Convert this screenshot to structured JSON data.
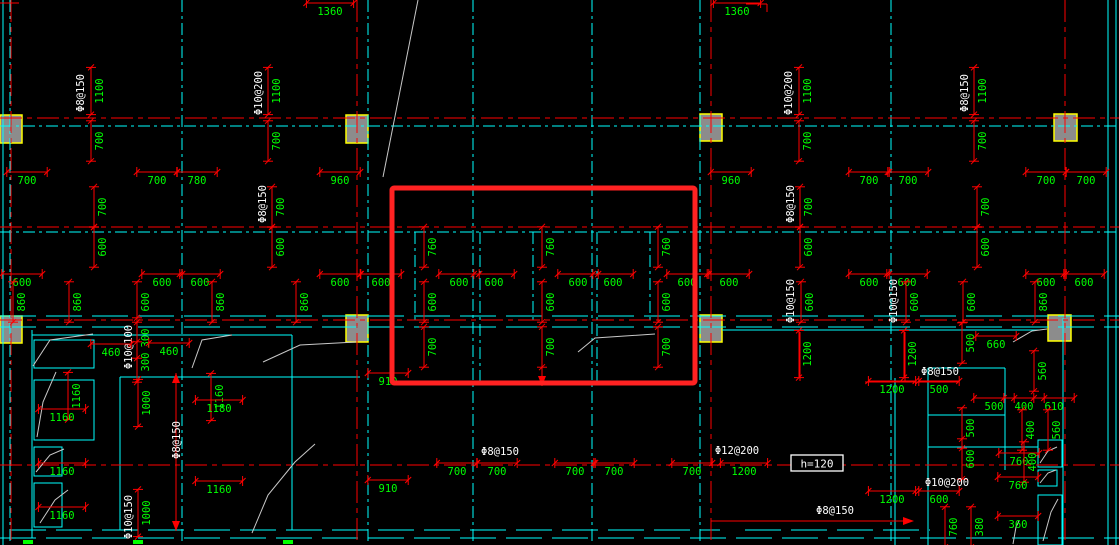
{
  "scene": {
    "w": 1119,
    "h": 545,
    "bg": "#000000"
  },
  "colors": {
    "grid_cyan": "#00ffff",
    "axis_red": "#ff0000",
    "dim_red": "#ff0000",
    "dim_text_green": "#00ff00",
    "rebar_text_white": "#ffffff",
    "column_fill": "#8c8c8c",
    "column_border": "#ffff00",
    "break_line_gray": "#c8c8c8",
    "highlight_red": "#ff2222"
  },
  "highlight_rect": {
    "x": 392,
    "y": 188,
    "w": 303,
    "h": 195,
    "stroke_width": 5
  },
  "note_box": {
    "text": "h=120",
    "x": 791,
    "y": 455,
    "w": 52,
    "h": 16
  },
  "columns": [
    [
      0,
      115,
      22,
      28
    ],
    [
      346,
      115,
      22,
      28
    ],
    [
      700,
      114,
      22,
      27
    ],
    [
      1054,
      114,
      23,
      27
    ],
    [
      0,
      316,
      22,
      27
    ],
    [
      346,
      315,
      22,
      27
    ],
    [
      700,
      315,
      22,
      27
    ],
    [
      1048,
      315,
      23,
      26
    ]
  ],
  "axes": {
    "horizontal": [
      118,
      227,
      320,
      465
    ],
    "vertical": [
      11,
      357,
      711,
      1065
    ]
  },
  "cyan_lines": [
    [
      3,
      0,
      3,
      545,
      "solid"
    ],
    [
      10,
      0,
      10,
      545,
      "grid"
    ],
    [
      182,
      0,
      182,
      545,
      "grid"
    ],
    [
      368,
      0,
      368,
      545,
      "grid"
    ],
    [
      473,
      0,
      473,
      545,
      "grid"
    ],
    [
      592,
      0,
      592,
      545,
      "grid"
    ],
    [
      700,
      0,
      700,
      545,
      "grid"
    ],
    [
      891,
      0,
      891,
      545,
      "grid"
    ],
    [
      1108,
      0,
      1108,
      545,
      "solid"
    ],
    [
      1116,
      0,
      1116,
      545,
      "solid"
    ],
    [
      415,
      232,
      415,
      322,
      "grid"
    ],
    [
      480,
      232,
      480,
      385,
      "grid"
    ],
    [
      533,
      232,
      533,
      322,
      "grid"
    ],
    [
      597,
      232,
      597,
      385,
      "grid"
    ],
    [
      650,
      232,
      650,
      322,
      "grid"
    ],
    [
      0,
      126,
      1119,
      126,
      "grid"
    ],
    [
      0,
      232,
      1119,
      232,
      "grid"
    ],
    [
      0,
      316,
      1119,
      316,
      "long"
    ],
    [
      0,
      327,
      1119,
      327,
      "long"
    ],
    [
      32,
      330,
      32,
      538,
      "solid"
    ],
    [
      32,
      335,
      292,
      335,
      "solid"
    ],
    [
      292,
      335,
      292,
      530,
      "solid"
    ],
    [
      120,
      377,
      120,
      530,
      "solid"
    ],
    [
      120,
      377,
      360,
      377,
      "solid"
    ],
    [
      10,
      530,
      720,
      530,
      "long"
    ],
    [
      0,
      538,
      1119,
      538,
      "long"
    ],
    [
      722,
      330,
      1040,
      330,
      "solid"
    ],
    [
      895,
      378,
      895,
      545,
      "solid"
    ],
    [
      928,
      368,
      928,
      545,
      "solid"
    ],
    [
      928,
      368,
      1005,
      368,
      "solid"
    ],
    [
      928,
      415,
      1005,
      415,
      "solid"
    ],
    [
      928,
      447,
      1038,
      447,
      "solid"
    ],
    [
      1005,
      368,
      1005,
      470,
      "solid"
    ],
    [
      1063,
      318,
      1063,
      545,
      "solid"
    ],
    [
      745,
      530,
      930,
      530,
      "long"
    ]
  ],
  "cyan_rects": [
    [
      34,
      340,
      60,
      28
    ],
    [
      34,
      380,
      60,
      60
    ],
    [
      34,
      447,
      28,
      29
    ],
    [
      34,
      483,
      28,
      44
    ],
    [
      1038,
      440,
      24,
      27
    ],
    [
      1038,
      470,
      19,
      16
    ],
    [
      1038,
      495,
      24,
      50
    ]
  ],
  "red_segments": [
    [
      0,
      3,
      19,
      3
    ],
    [
      746,
      4,
      767,
      4
    ],
    [
      767,
      4,
      767,
      12
    ],
    [
      800,
      332,
      800,
      381
    ],
    [
      905,
      332,
      905,
      381
    ],
    [
      865,
      382,
      958,
      382
    ],
    [
      542,
      367,
      542,
      386
    ],
    [
      711,
      521,
      905,
      521
    ],
    [
      176,
      373,
      176,
      531
    ]
  ],
  "red_arrows": [
    {
      "x": 905,
      "y": 521,
      "d": "r"
    },
    {
      "x": 176,
      "y": 373,
      "d": "u"
    },
    {
      "x": 176,
      "y": 531,
      "d": "d"
    },
    {
      "x": 542,
      "y": 386,
      "d": "d"
    }
  ],
  "bottom_ticks": [
    [
      23,
      540
    ],
    [
      133,
      540
    ],
    [
      283,
      540
    ]
  ],
  "break_lines": [
    [
      [
        418,
        0
      ],
      [
        383,
        177
      ]
    ],
    [
      [
        33,
        366
      ],
      [
        50,
        340
      ],
      [
        93,
        334
      ]
    ],
    [
      [
        37,
        437
      ],
      [
        43,
        402
      ],
      [
        56,
        372
      ]
    ],
    [
      [
        192,
        368
      ],
      [
        202,
        340
      ],
      [
        232,
        335
      ]
    ],
    [
      [
        263,
        362
      ],
      [
        300,
        345
      ],
      [
        356,
        342
      ]
    ],
    [
      [
        252,
        533
      ],
      [
        268,
        495
      ],
      [
        295,
        462
      ],
      [
        315,
        444
      ]
    ],
    [
      [
        36,
        472
      ],
      [
        50,
        455
      ],
      [
        64,
        449
      ]
    ],
    [
      [
        40,
        523
      ],
      [
        55,
        500
      ],
      [
        68,
        490
      ]
    ],
    [
      [
        578,
        352
      ],
      [
        595,
        338
      ],
      [
        655,
        334
      ]
    ],
    [
      [
        1013,
        342
      ],
      [
        1032,
        331
      ],
      [
        1047,
        329
      ]
    ],
    [
      [
        1040,
        463
      ],
      [
        1048,
        451
      ],
      [
        1057,
        447
      ]
    ],
    [
      [
        1040,
        483
      ],
      [
        1048,
        473
      ],
      [
        1056,
        470
      ]
    ],
    [
      [
        1043,
        541
      ],
      [
        1051,
        512
      ],
      [
        1058,
        499
      ]
    ],
    [
      [
        1013,
        544
      ],
      [
        1016,
        527
      ],
      [
        1019,
        521
      ]
    ]
  ],
  "labels": [
    {
      "t": "1360",
      "x": 330,
      "y": 12
    },
    {
      "t": "1360",
      "x": 737,
      "y": 12
    },
    {
      "t": "Φ8@150",
      "x": 81,
      "y": 93,
      "r": 1,
      "c": "w"
    },
    {
      "t": "1100",
      "x": 100,
      "y": 91,
      "r": 1
    },
    {
      "t": "700",
      "x": 100,
      "y": 141,
      "r": 1
    },
    {
      "t": "Φ10@200",
      "x": 259,
      "y": 93,
      "r": 1,
      "c": "w"
    },
    {
      "t": "1100",
      "x": 277,
      "y": 91,
      "r": 1
    },
    {
      "t": "700",
      "x": 277,
      "y": 141,
      "r": 1
    },
    {
      "t": "Φ10@200",
      "x": 789,
      "y": 93,
      "r": 1,
      "c": "w"
    },
    {
      "t": "1100",
      "x": 808,
      "y": 91,
      "r": 1
    },
    {
      "t": "700",
      "x": 808,
      "y": 141,
      "r": 1
    },
    {
      "t": "Φ8@150",
      "x": 965,
      "y": 93,
      "r": 1,
      "c": "w"
    },
    {
      "t": "1100",
      "x": 983,
      "y": 91,
      "r": 1
    },
    {
      "t": "700",
      "x": 983,
      "y": 141,
      "r": 1
    },
    {
      "t": "700",
      "x": 27,
      "y": 181
    },
    {
      "t": "700",
      "x": 157,
      "y": 181
    },
    {
      "t": "780",
      "x": 197,
      "y": 181
    },
    {
      "t": "960",
      "x": 340,
      "y": 181
    },
    {
      "t": "960",
      "x": 731,
      "y": 181
    },
    {
      "t": "700",
      "x": 869,
      "y": 181
    },
    {
      "t": "700",
      "x": 908,
      "y": 181
    },
    {
      "t": "700",
      "x": 1046,
      "y": 181
    },
    {
      "t": "700",
      "x": 1086,
      "y": 181
    },
    {
      "t": "700",
      "x": 103,
      "y": 207,
      "r": 1
    },
    {
      "t": "600",
      "x": 103,
      "y": 247,
      "r": 1
    },
    {
      "t": "Φ8@150",
      "x": 263,
      "y": 204,
      "r": 1,
      "c": "w"
    },
    {
      "t": "700",
      "x": 281,
      "y": 207,
      "r": 1
    },
    {
      "t": "600",
      "x": 281,
      "y": 247,
      "r": 1
    },
    {
      "t": "Φ8@150",
      "x": 791,
      "y": 204,
      "r": 1,
      "c": "w"
    },
    {
      "t": "700",
      "x": 809,
      "y": 207,
      "r": 1
    },
    {
      "t": "600",
      "x": 809,
      "y": 247,
      "r": 1
    },
    {
      "t": "700",
      "x": 986,
      "y": 207,
      "r": 1
    },
    {
      "t": "600",
      "x": 986,
      "y": 247,
      "r": 1
    },
    {
      "t": "760",
      "x": 433,
      "y": 247,
      "r": 1
    },
    {
      "t": "760",
      "x": 551,
      "y": 247,
      "r": 1
    },
    {
      "t": "760",
      "x": 667,
      "y": 247,
      "r": 1
    },
    {
      "t": "600",
      "x": 433,
      "y": 302,
      "r": 1
    },
    {
      "t": "600",
      "x": 551,
      "y": 302,
      "r": 1
    },
    {
      "t": "600",
      "x": 667,
      "y": 302,
      "r": 1
    },
    {
      "t": "700",
      "x": 433,
      "y": 347,
      "r": 1
    },
    {
      "t": "700",
      "x": 551,
      "y": 347,
      "r": 1
    },
    {
      "t": "700",
      "x": 667,
      "y": 347,
      "r": 1
    },
    {
      "t": "600",
      "x": 22,
      "y": 283
    },
    {
      "t": "600",
      "x": 162,
      "y": 283
    },
    {
      "t": "600",
      "x": 200,
      "y": 283
    },
    {
      "t": "600",
      "x": 340,
      "y": 283
    },
    {
      "t": "600",
      "x": 381,
      "y": 283
    },
    {
      "t": "600",
      "x": 459,
      "y": 283
    },
    {
      "t": "600",
      "x": 494,
      "y": 283
    },
    {
      "t": "600",
      "x": 578,
      "y": 283
    },
    {
      "t": "600",
      "x": 613,
      "y": 283
    },
    {
      "t": "600",
      "x": 687,
      "y": 283
    },
    {
      "t": "600",
      "x": 729,
      "y": 283
    },
    {
      "t": "600",
      "x": 869,
      "y": 283
    },
    {
      "t": "600",
      "x": 907,
      "y": 283
    },
    {
      "t": "600",
      "x": 1046,
      "y": 283
    },
    {
      "t": "600",
      "x": 1084,
      "y": 283
    },
    {
      "t": "860",
      "x": 22,
      "y": 302,
      "r": 1
    },
    {
      "t": "860",
      "x": 78,
      "y": 302,
      "r": 1
    },
    {
      "t": "600",
      "x": 146,
      "y": 302,
      "r": 1
    },
    {
      "t": "860",
      "x": 221,
      "y": 302,
      "r": 1
    },
    {
      "t": "860",
      "x": 305,
      "y": 302,
      "r": 1
    },
    {
      "t": "Φ10@150",
      "x": 791,
      "y": 301,
      "r": 1,
      "c": "w"
    },
    {
      "t": "600",
      "x": 810,
      "y": 302,
      "r": 1
    },
    {
      "t": "Φ10@150",
      "x": 894,
      "y": 301,
      "r": 1,
      "c": "w"
    },
    {
      "t": "600",
      "x": 915,
      "y": 302,
      "r": 1
    },
    {
      "t": "600",
      "x": 972,
      "y": 302,
      "r": 1
    },
    {
      "t": "860",
      "x": 1044,
      "y": 302,
      "r": 1
    },
    {
      "t": "500",
      "x": 971,
      "y": 343,
      "r": 1
    },
    {
      "t": "660",
      "x": 996,
      "y": 345
    },
    {
      "t": "1200",
      "x": 808,
      "y": 354,
      "r": 1
    },
    {
      "t": "1200",
      "x": 913,
      "y": 354,
      "r": 1
    },
    {
      "t": "Φ10@100",
      "x": 129,
      "y": 347,
      "r": 1,
      "c": "w"
    },
    {
      "t": "300",
      "x": 146,
      "y": 338,
      "r": 1
    },
    {
      "t": "460",
      "x": 111,
      "y": 353
    },
    {
      "t": "460",
      "x": 169,
      "y": 352
    },
    {
      "t": "300",
      "x": 146,
      "y": 362,
      "r": 1
    },
    {
      "t": "1160",
      "x": 77,
      "y": 396,
      "r": 1
    },
    {
      "t": "1000",
      "x": 147,
      "y": 403,
      "r": 1
    },
    {
      "t": "1160",
      "x": 220,
      "y": 397,
      "r": 1
    },
    {
      "t": "1160",
      "x": 62,
      "y": 418
    },
    {
      "t": "1180",
      "x": 219,
      "y": 409
    },
    {
      "t": "Φ8@150",
      "x": 177,
      "y": 440,
      "r": 1,
      "c": "w"
    },
    {
      "t": "1160",
      "x": 62,
      "y": 472
    },
    {
      "t": "1160",
      "x": 219,
      "y": 490
    },
    {
      "t": "1160",
      "x": 62,
      "y": 516
    },
    {
      "t": "Φ10@150",
      "x": 129,
      "y": 517,
      "r": 1,
      "c": "w"
    },
    {
      "t": "1000",
      "x": 147,
      "y": 513,
      "r": 1
    },
    {
      "t": "910",
      "x": 388,
      "y": 382
    },
    {
      "t": "910",
      "x": 388,
      "y": 489
    },
    {
      "t": "Φ8@150",
      "x": 500,
      "y": 452,
      "c": "w"
    },
    {
      "t": "Φ12@200",
      "x": 737,
      "y": 451,
      "c": "w"
    },
    {
      "t": "700",
      "x": 457,
      "y": 472
    },
    {
      "t": "700",
      "x": 497,
      "y": 472
    },
    {
      "t": "700",
      "x": 575,
      "y": 472
    },
    {
      "t": "700",
      "x": 614,
      "y": 472
    },
    {
      "t": "700",
      "x": 692,
      "y": 472
    },
    {
      "t": "1200",
      "x": 744,
      "y": 472
    },
    {
      "t": "Φ8@150",
      "x": 940,
      "y": 372,
      "c": "w"
    },
    {
      "t": "560",
      "x": 1043,
      "y": 371,
      "r": 1
    },
    {
      "t": "1200",
      "x": 892,
      "y": 390
    },
    {
      "t": "500",
      "x": 939,
      "y": 390
    },
    {
      "t": "500",
      "x": 994,
      "y": 407
    },
    {
      "t": "400",
      "x": 1024,
      "y": 407
    },
    {
      "t": "610",
      "x": 1054,
      "y": 407
    },
    {
      "t": "500",
      "x": 971,
      "y": 428,
      "r": 1
    },
    {
      "t": "400",
      "x": 1031,
      "y": 430,
      "r": 1
    },
    {
      "t": "560",
      "x": 1057,
      "y": 430,
      "r": 1
    },
    {
      "t": "600",
      "x": 971,
      "y": 459,
      "r": 1
    },
    {
      "t": "760",
      "x": 1019,
      "y": 462
    },
    {
      "t": "400",
      "x": 1033,
      "y": 462,
      "r": 1
    },
    {
      "t": "760",
      "x": 1018,
      "y": 486
    },
    {
      "t": "Φ10@200",
      "x": 947,
      "y": 483,
      "c": "w"
    },
    {
      "t": "1200",
      "x": 892,
      "y": 500
    },
    {
      "t": "600",
      "x": 939,
      "y": 500
    },
    {
      "t": "Φ8@150",
      "x": 835,
      "y": 511,
      "c": "w"
    },
    {
      "t": "760",
      "x": 954,
      "y": 527,
      "r": 1
    },
    {
      "t": "380",
      "x": 980,
      "y": 527,
      "r": 1
    },
    {
      "t": "360",
      "x": 1018,
      "y": 525
    }
  ]
}
